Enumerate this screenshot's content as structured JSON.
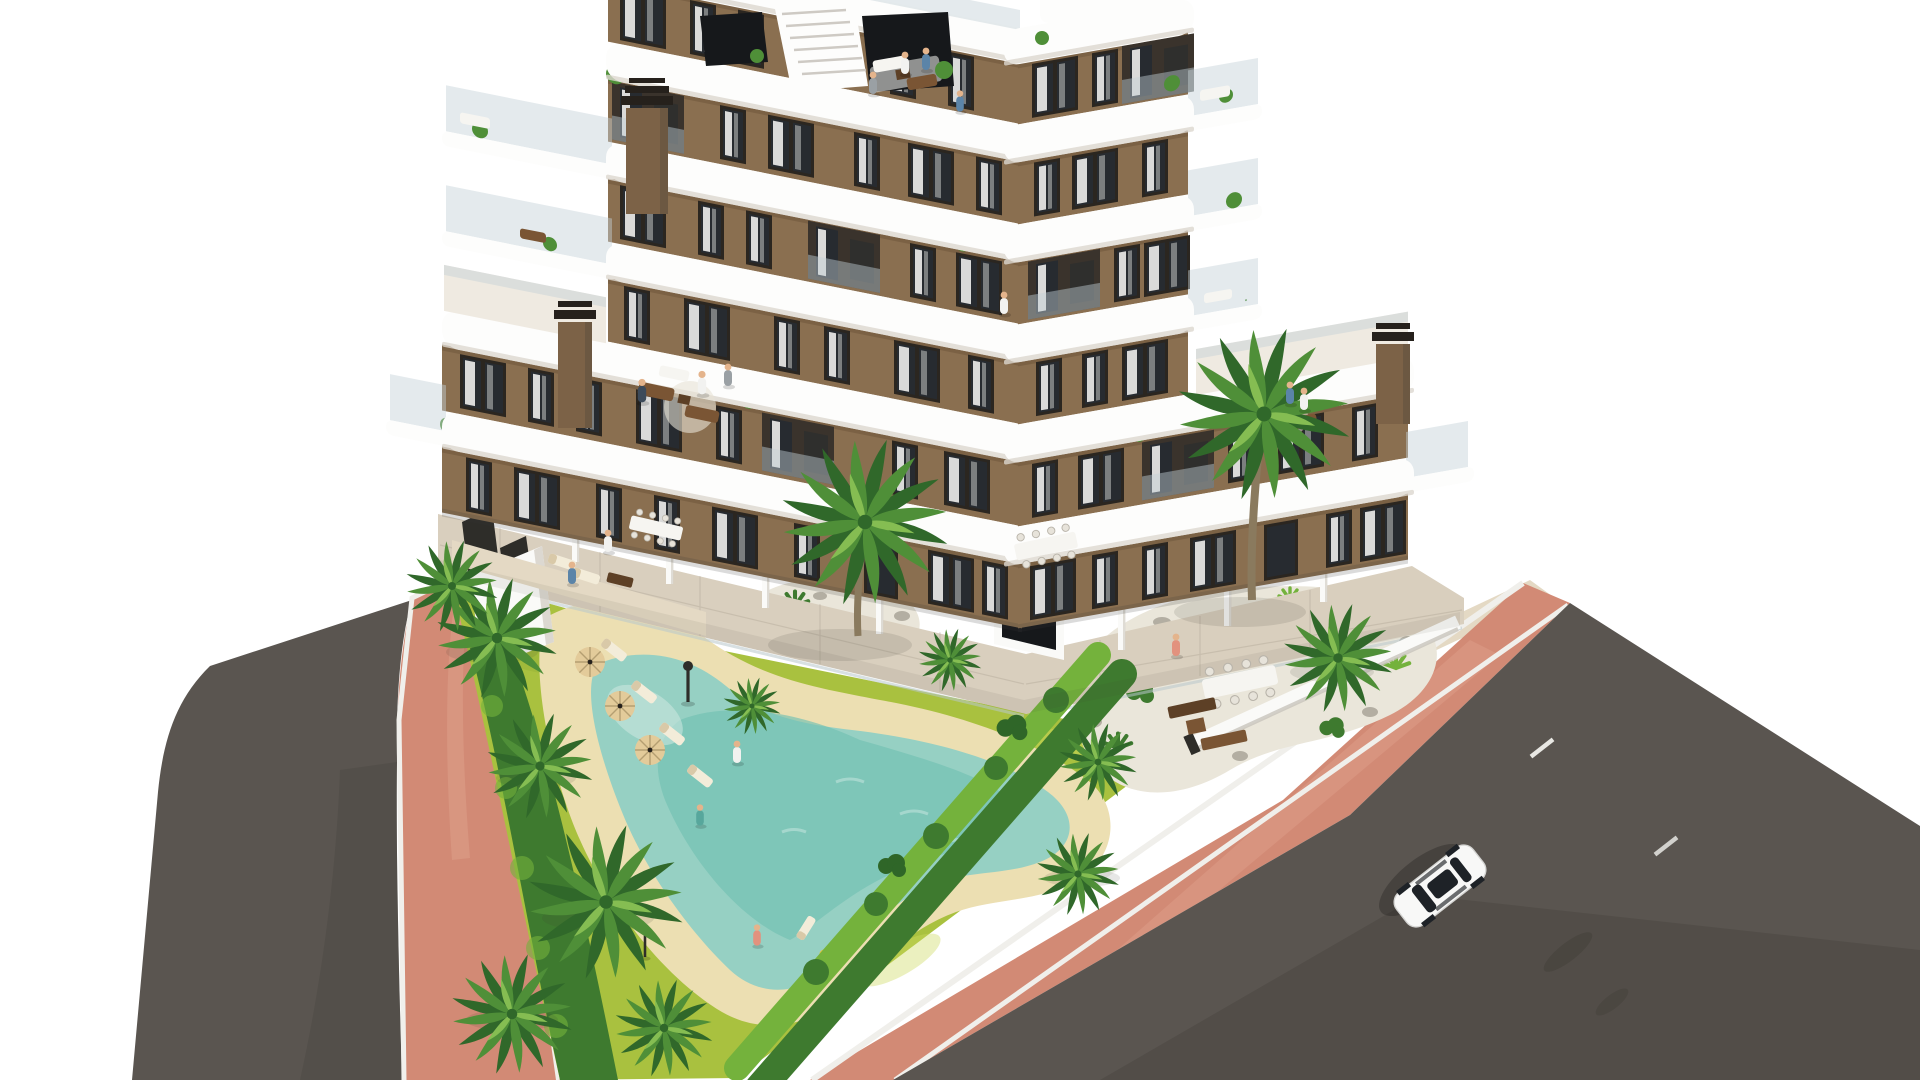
{
  "meta": {
    "title": "New-build apartment residence — aerial render",
    "description": "Aerial 3D architectural rendering of a brown modern apartment building with white curved wrap-around balconies, rooftop terraces with people, a landscaped garden with palm trees, a freeform turquoise swimming pool with sun loungers and parasols, terracotta-pink sidewalks and dark asphalt roads with a single white car"
  },
  "palette": {
    "background": "#ffffff",
    "facade": "#8a6f50",
    "facade_dark": "#6f573c",
    "facade_light": "#9c7f5c",
    "band_white": "#fdfdfc",
    "band_shadow": "#ddd8d0",
    "window_frame": "#2b2620",
    "window_glass": "#272b30",
    "curtain": "#f4f3f0",
    "recess_dark": "#3a332c",
    "glass_rail": "#c3d0d6",
    "dark_glass": "#16181b",
    "terrace_floor": "#efeae1",
    "terrace_tile": "#d9cfbe",
    "path_beige": "#e4d9c4",
    "wall_white": "#fafaf8",
    "wall_shade": "#d8d4cc",
    "fence_dark": "#2e2d29",
    "lawn": "#a9c13f",
    "lawn_light": "#cdd95e",
    "lawn_dark": "#8fae35",
    "hedge": "#3e7a2f",
    "hedge_light": "#74b23c",
    "palm": "#4f8f38",
    "palm_dark": "#30682a",
    "palm_light": "#85bd52",
    "trunk": "#8a7a5e",
    "gravel": "#eae6da",
    "rock": "#b3aea2",
    "pool_water": "#96d0c3",
    "pool_deep": "#72c0b2",
    "pool_edge": "#c9e6dd",
    "deck_sand": "#ecdfb2",
    "umbrella": "#e3cb9a",
    "umbrella_line": "#b59f72",
    "lounger": "#f3ecd9",
    "lounger_accent": "#d9c9a8",
    "wood_dark": "#5d4026",
    "wood_mid": "#7a5534",
    "furniture_white": "#f6f5f1",
    "road": "#5a5550",
    "road_dark": "#49453f",
    "lane_mark": "#e8e7e3",
    "sidewalk_pink": "#d28a75",
    "sidewalk_pink_light": "#e0a38e",
    "curb": "#f0efeb",
    "car_body": "#f8f8f7",
    "car_glass": "#1e2227",
    "skin": "#e4b48c",
    "shadow": "#3a3a35",
    "chimney_body": "#7c6247",
    "chimney_cap": "#26211c",
    "person_blue": "#5b84a8",
    "person_white": "#f2f2f0",
    "person_gray": "#9aa0a4",
    "person_salmon": "#e2927e",
    "person_teal": "#57a79c",
    "person_navy": "#3c4a5a"
  },
  "scene": {
    "building": {
      "style": "modern apartment block, two wings in a V seen from above",
      "facade": "brown stucco",
      "balconies": "white curved wrap-around slab bands with glass balustrades",
      "floors_visible": 7,
      "chimneys": 3,
      "rooftop": "penthouse terrace with external staircase, dark glass walls, lounge furniture",
      "roof_terraces": [
        "left wing terrace with seating and people",
        "right wing terrace with seating and people"
      ]
    },
    "grounds": {
      "lawn": "yellow-green mottled grass",
      "palm_trees": 10,
      "planting_islands": 2,
      "hedges": "trimmed double hedge rows along plot edges",
      "ground_terraces": "beige tiled private terraces with white privacy walls, dining tables and seating"
    },
    "pool": {
      "shape": "freeform lagoon",
      "water": "turquoise",
      "deck": "sand-colored beach deck",
      "sun_loungers": 6,
      "parasols": 3,
      "lamp_posts": 2
    },
    "streets": {
      "left_road": "dark asphalt, curving",
      "right_road": "dark asphalt, diagonal",
      "sidewalks": "terracotta pink pavers with white curbs",
      "lane_markings": 2,
      "car": {
        "color": "white",
        "type": "sedan",
        "location": "right road",
        "heading": "down-left"
      }
    },
    "people_count": 16
  }
}
